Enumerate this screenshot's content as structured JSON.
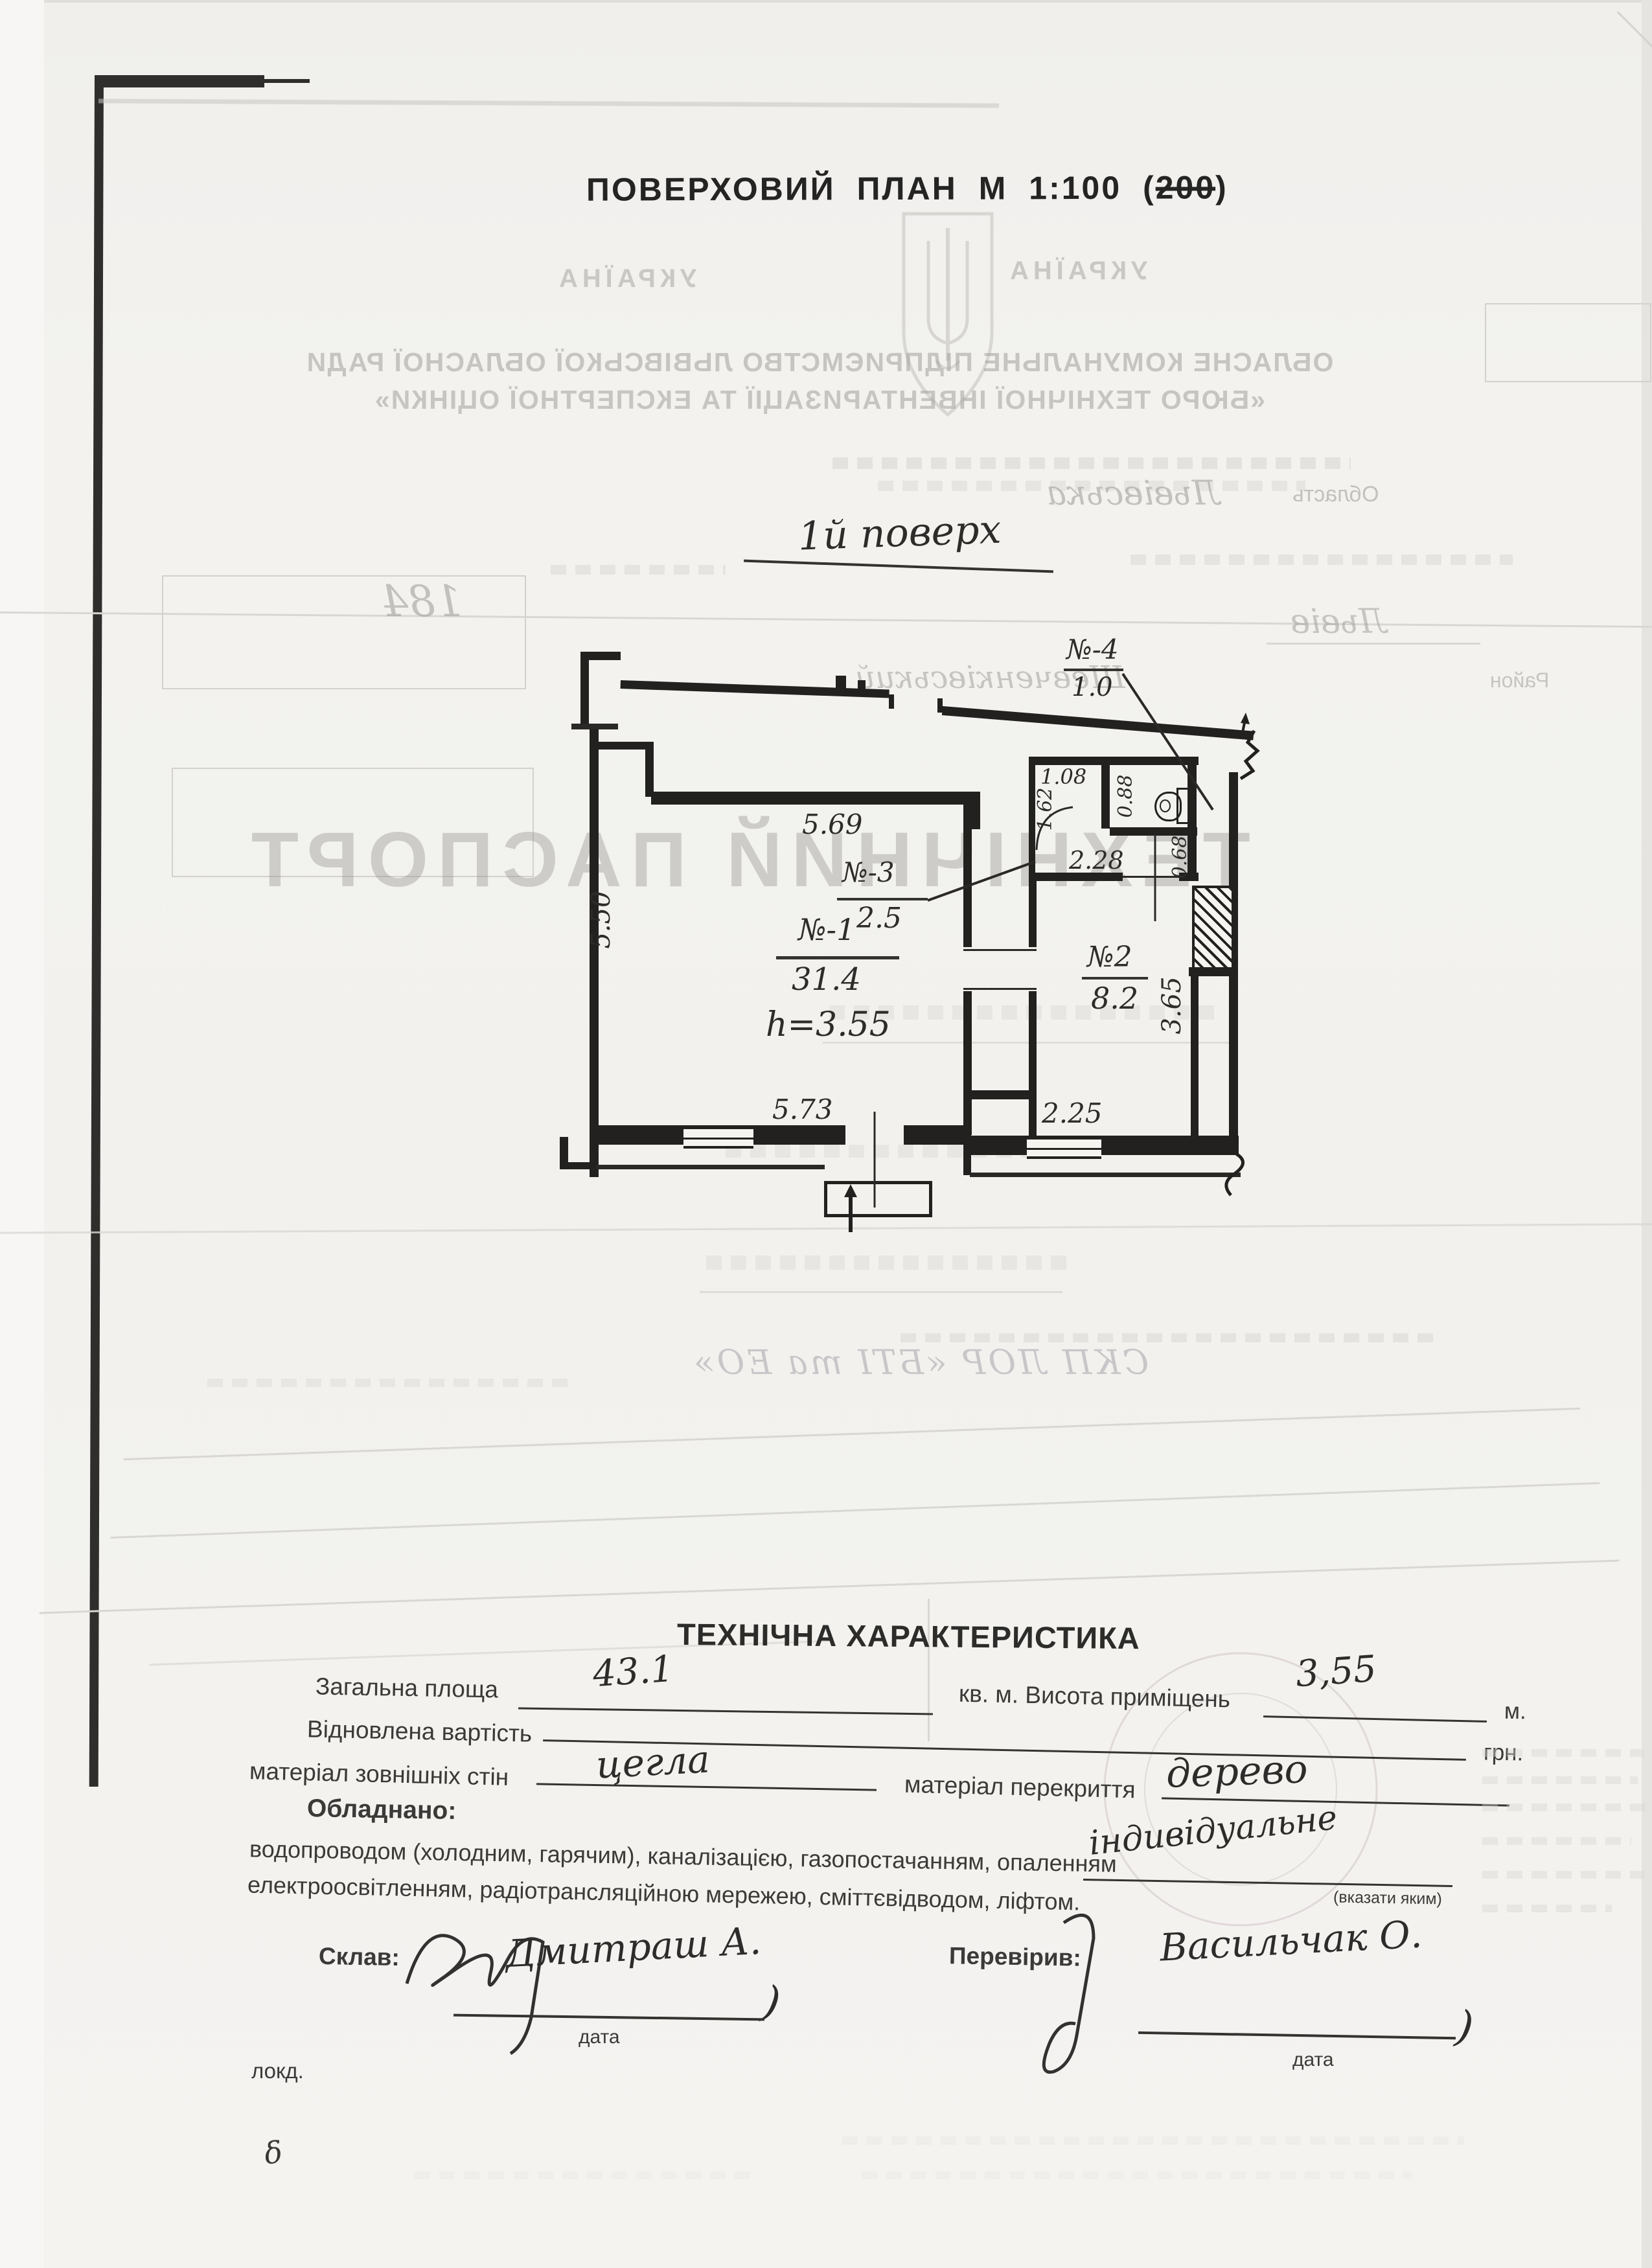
{
  "page": {
    "title_main": "ПОВЕРХОВИЙ ПЛАН М 1:100",
    "title_paren_open": "(",
    "title_struck": "200",
    "title_paren_close": ")",
    "floor_label": "1й поверх"
  },
  "plan": {
    "rooms": {
      "r1_num": "№-1",
      "r1_area": "31.4",
      "r2_num": "№2",
      "r2_area": "8.2",
      "r3_num": "№-3",
      "r3_area": "2.5",
      "r4_num": "№-4",
      "r4_area": "1.0"
    },
    "height_note": "h=3.55",
    "dims": {
      "top": "5.69",
      "left": "5.50",
      "bottom": "5.73",
      "room2_bottom": "2.25",
      "room2_right": "3.65",
      "corridor": "2.28",
      "corridor_top": "1.08",
      "corridor_left": "1.62",
      "wc_side": "0.88",
      "wc_below": "0.68"
    }
  },
  "bleed": {
    "country": "УКРАЇНА",
    "org_line1": "ОБЛАСНЕ КОМУНАЛЬНЕ ПІДПРИЄМСТВО ЛЬВІВСЬКОЇ ОБЛАСНОЇ РАДИ",
    "org_line2": "«БЮРО ТЕХНІЧНОЇ ІНВЕНТАРИЗАЦІЇ ТА ЕКСПЕРТНОЇ ОЦІНКИ»",
    "passport": "ТЕХНІЧНИЙ ПАСПОРТ",
    "oblast_label": "Область",
    "oblast_value": "Львівська",
    "city_value": "Львів",
    "district_label": "Район",
    "district_value": "Шевченківський",
    "number": "184",
    "stamp_line": "СКП ЛОР «БТІ та ЕО»"
  },
  "tech": {
    "heading": "ТЕХНІЧНА ХАРАКТЕРИСТИКА",
    "total_area_label": "Загальна площа",
    "total_area_value": "43.1",
    "height_label": "кв. м. Висота приміщень",
    "height_value": "3,55",
    "height_unit": "м.",
    "restored_label": "Відновлена вартість",
    "restored_unit": "грн.",
    "walls_label": "матеріал зовнішніх стін",
    "walls_value": "цегла",
    "ceiling_label": "матеріал перекриття",
    "ceiling_value": "дерево",
    "equipped_label": "Обладнано:",
    "equipped_line1": "водопроводом (холодним, гарячим), каналізацією, газопостачанням, опаленням",
    "equipped_value": "індивідуальне",
    "equipped_hint": "(вказати яким)",
    "equipped_line2": "електроосвітленням, радіотрансляційною мережею, сміттєвідводом, ліфтом."
  },
  "footer": {
    "composed_label": "Склав:",
    "composed_name": "Дмитраш А.",
    "checked_label": "Перевірив:",
    "checked_name": "Васильчак О.",
    "date_label": "дата",
    "paren": ")",
    "lokd": "локд.",
    "mark": "δ"
  }
}
